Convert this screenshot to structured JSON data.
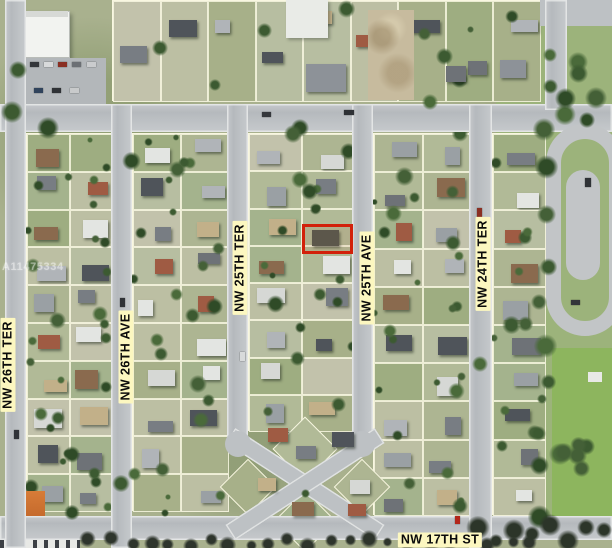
{
  "map": {
    "description": "Aerial satellite neighborhood map with highlighted subject parcel",
    "watermark": "A11475334",
    "highlight": {
      "x": 302,
      "y": 224,
      "width": 51,
      "height": 30,
      "color": "#d2200a"
    },
    "street_labels": [
      {
        "id": "nw-26th-ter",
        "text": "NW 26TH TER",
        "orientation": "vertical",
        "cx": 8,
        "cy": 365
      },
      {
        "id": "nw-26th-ave",
        "text": "NW 26TH AVE",
        "orientation": "vertical",
        "cx": 126,
        "cy": 357
      },
      {
        "id": "nw-25th-ter",
        "text": "NW 25TH TER",
        "orientation": "vertical",
        "cx": 240,
        "cy": 268
      },
      {
        "id": "nw-25th-ave",
        "text": "NW 25TH AVE",
        "orientation": "vertical",
        "cx": 367,
        "cy": 278
      },
      {
        "id": "nw-24th-ter",
        "text": "NW 24TH TER",
        "orientation": "vertical",
        "cx": 483,
        "cy": 264
      },
      {
        "id": "nw-17th-st",
        "text": "NW 17TH ST",
        "orientation": "horizontal",
        "cx": 440,
        "cy": 540
      }
    ],
    "colors": {
      "highlight": "#d2200a",
      "label_bg": "#fcf7c0",
      "label_text": "#0a0a0a",
      "road": "#bdc1c4",
      "parcel_line": "#fdfbe6",
      "park_green": "#9cb37b"
    }
  }
}
